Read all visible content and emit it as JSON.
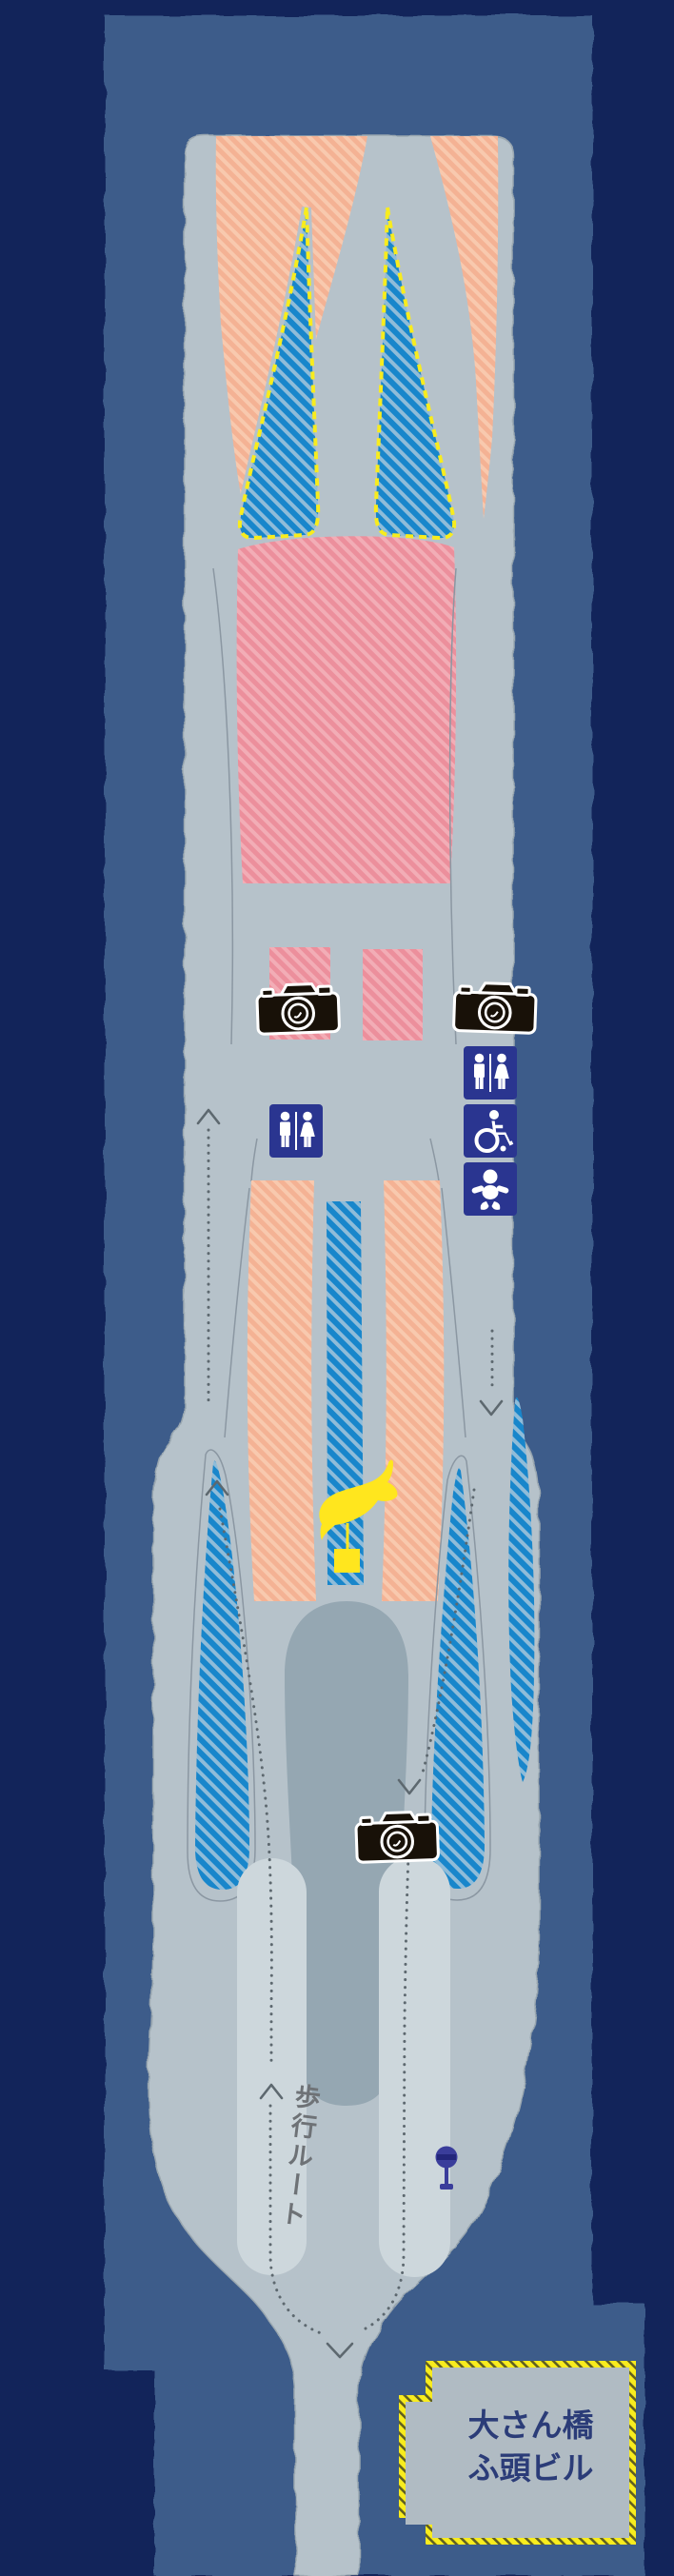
{
  "colors": {
    "background": "#12245a",
    "water": "#3d5c8a",
    "pier": "#b6c2ca",
    "pier_outline": "#9aa7b0",
    "walkway": "#cdd7dc",
    "plaza": "#95a7b2",
    "orange_zone": "#f4b294",
    "orange_stripe": "#f8c9ae",
    "pink_zone": "#ec8f9c",
    "pink_stripe": "#f2adb6",
    "blue_zone": "#1886cb",
    "blue_stripe": "#8fbcd9",
    "highlight_yellow": "#f8ec1e",
    "rope_dark": "#5f5f23",
    "sign_blue": "#2a3590",
    "sign_blue_dark": "#23267b",
    "route_gray": "#5d686f",
    "line_gray": "#8b97a2",
    "whale_yellow": "#ffe61e",
    "text_navy": "#2b3c78",
    "route_text": "#6e7276",
    "marker_purple": "#3a3d9b",
    "camera_black": "#181108",
    "building_fill": "#b0bbc3"
  },
  "labels": {
    "walking_route": "歩行ルート",
    "building_line1": "大さん橋",
    "building_line2": "ふ頭ビル"
  },
  "icons": {
    "photo_spots": [
      {
        "name": "camera-photo-spot-upper-left"
      },
      {
        "name": "camera-photo-spot-upper-right"
      },
      {
        "name": "camera-photo-spot-lower"
      }
    ],
    "facilities": [
      {
        "name": "restroom-sign-left"
      },
      {
        "name": "restroom-sign-right"
      },
      {
        "name": "wheelchair-accessible-sign"
      },
      {
        "name": "baby-care-sign"
      }
    ],
    "landmarks": [
      {
        "name": "whale-sculpture-marker"
      },
      {
        "name": "signpost-marker"
      }
    ],
    "route_arrows": [
      "up-chevron",
      "down-chevron"
    ]
  }
}
